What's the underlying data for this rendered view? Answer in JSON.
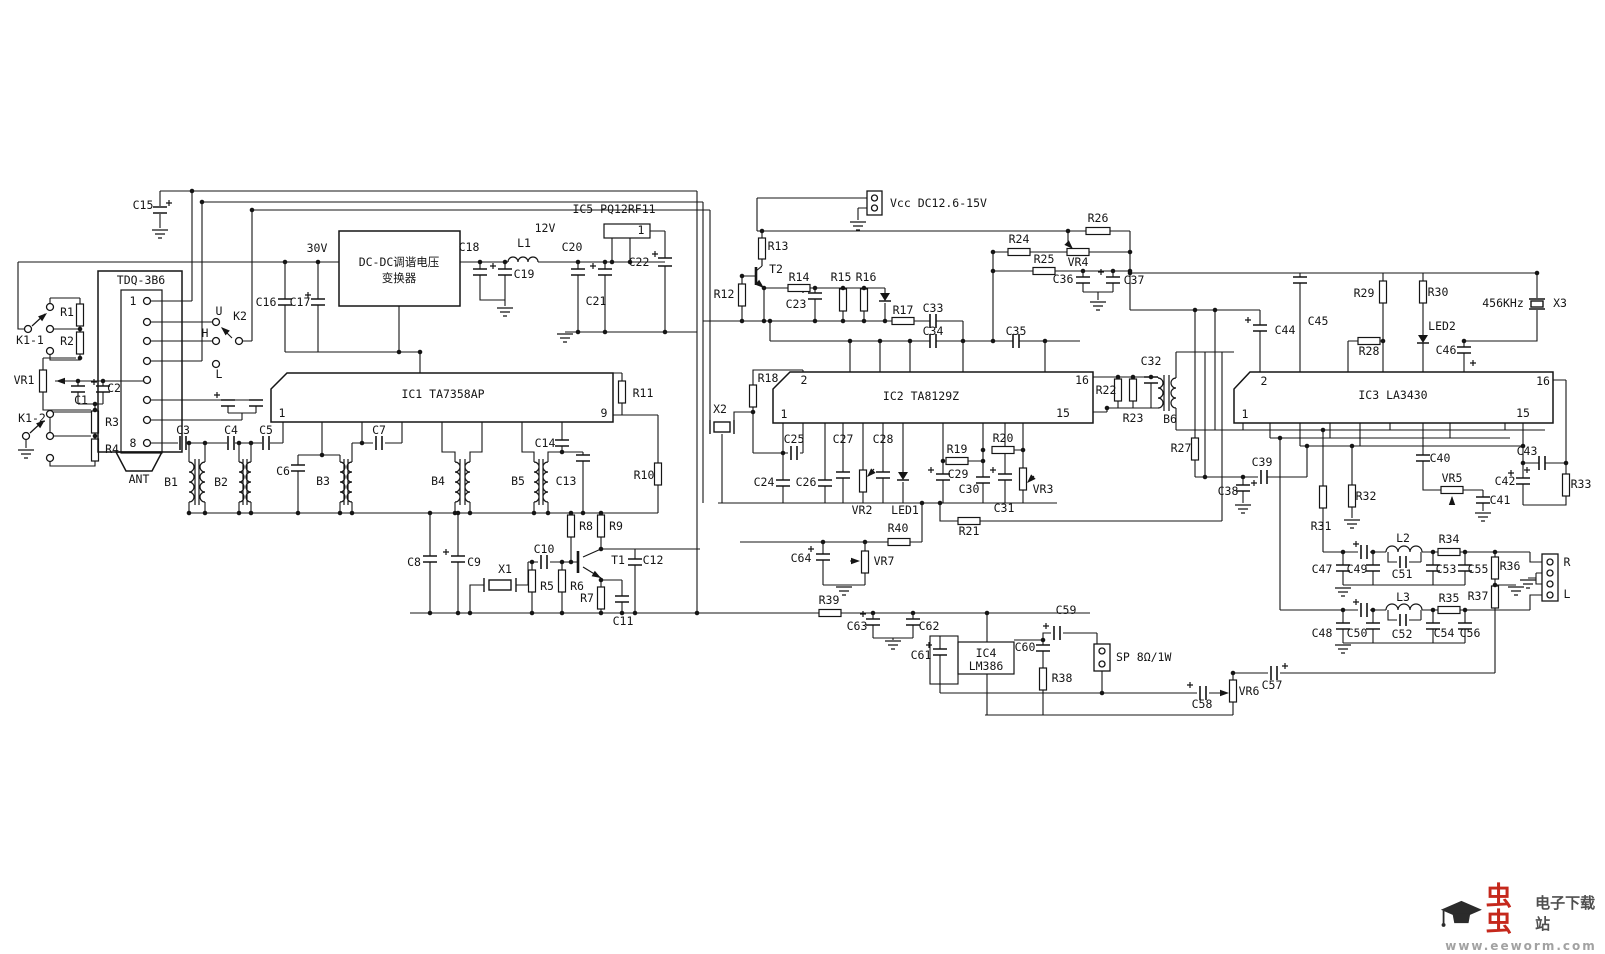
{
  "title": "FM radio receiver schematic (TA7358AP / TA8129Z / LA3430 / LM386)",
  "colors": {
    "ink": "#151515",
    "background": "#ffffff",
    "watermark_red": "#c5281c",
    "watermark_gray": "#4f4f4f",
    "watermark_url_gray": "#a2a2a2"
  },
  "watermark": {
    "brand": "虫虫",
    "site": "电子下载站",
    "url": "www.eeworm.com",
    "icon": "graduation-cap-icon"
  },
  "labels": [
    {
      "id": "c15",
      "t": "C15",
      "x": 143,
      "y": 209
    },
    {
      "id": "k1-1",
      "t": "K1-1",
      "x": 30,
      "y": 344
    },
    {
      "id": "r1",
      "t": "R1",
      "x": 67,
      "y": 316
    },
    {
      "id": "r2",
      "t": "R2",
      "x": 67,
      "y": 345
    },
    {
      "id": "vr1",
      "t": "VR1",
      "x": 24,
      "y": 384
    },
    {
      "id": "c1",
      "t": "C1",
      "x": 81,
      "y": 404,
      "fs": 11
    },
    {
      "id": "c2",
      "t": "C2",
      "x": 114,
      "y": 392
    },
    {
      "id": "k1-2",
      "t": "K1-2",
      "x": 32,
      "y": 422
    },
    {
      "id": "r3",
      "t": "R3",
      "x": 112,
      "y": 426
    },
    {
      "id": "r4",
      "t": "R4",
      "x": 112,
      "y": 453
    },
    {
      "id": "tdq",
      "t": "TDQ-3B6",
      "x": 141,
      "y": 284,
      "fs": 12
    },
    {
      "id": "tdq-pin1",
      "t": "1",
      "x": 133,
      "y": 305
    },
    {
      "id": "tdq-pin8",
      "t": "8",
      "x": 133,
      "y": 447
    },
    {
      "id": "ant",
      "t": "ANT",
      "x": 139,
      "y": 483
    },
    {
      "id": "k2-u",
      "t": "U",
      "x": 219,
      "y": 315
    },
    {
      "id": "k2",
      "t": "K2",
      "x": 240,
      "y": 320
    },
    {
      "id": "k2-h",
      "t": "H",
      "x": 205,
      "y": 337
    },
    {
      "id": "k2-l",
      "t": "L",
      "x": 219,
      "y": 378
    },
    {
      "id": "c16",
      "t": "C16",
      "x": 266,
      "y": 306
    },
    {
      "id": "c17",
      "t": "C17",
      "x": 300,
      "y": 306
    },
    {
      "id": "v30",
      "t": "30V",
      "x": 317,
      "y": 252
    },
    {
      "id": "dcdc1",
      "t": "DC-DC调谐电压",
      "x": 399,
      "y": 266,
      "fs": 13
    },
    {
      "id": "dcdc2",
      "t": "变换器",
      "x": 399,
      "y": 282,
      "fs": 13
    },
    {
      "id": "c18",
      "t": "C18",
      "x": 469,
      "y": 251
    },
    {
      "id": "l1",
      "t": "L1",
      "x": 524,
      "y": 247
    },
    {
      "id": "v12",
      "t": "12V",
      "x": 545,
      "y": 232
    },
    {
      "id": "c19",
      "t": "C19",
      "x": 524,
      "y": 278
    },
    {
      "id": "c20",
      "t": "C20",
      "x": 572,
      "y": 251
    },
    {
      "id": "c21",
      "t": "C21",
      "x": 596,
      "y": 305
    },
    {
      "id": "c22",
      "t": "C22",
      "x": 639,
      "y": 266
    },
    {
      "id": "ic5",
      "t": "IC5 PQ12RF11",
      "x": 614,
      "y": 213,
      "fs": 12
    },
    {
      "id": "ic5-pin1",
      "t": "1",
      "x": 641,
      "y": 234
    },
    {
      "id": "vcc",
      "t": "Vcc DC12.6-15V",
      "x": 890,
      "y": 207,
      "a": "start",
      "fs": 12
    },
    {
      "id": "r13",
      "t": "R13",
      "x": 778,
      "y": 250
    },
    {
      "id": "t2",
      "t": "T2",
      "x": 776,
      "y": 273
    },
    {
      "id": "r12",
      "t": "R12",
      "x": 724,
      "y": 298
    },
    {
      "id": "r14",
      "t": "R14",
      "x": 799,
      "y": 281
    },
    {
      "id": "c23",
      "t": "C23",
      "x": 796,
      "y": 308
    },
    {
      "id": "r15",
      "t": "R15",
      "x": 841,
      "y": 281
    },
    {
      "id": "r16",
      "t": "R16",
      "x": 866,
      "y": 281
    },
    {
      "id": "r17",
      "t": "R17",
      "x": 903,
      "y": 314
    },
    {
      "id": "c33",
      "t": "C33",
      "x": 933,
      "y": 312
    },
    {
      "id": "c34",
      "t": "C34",
      "x": 933,
      "y": 335
    },
    {
      "id": "c35",
      "t": "C35",
      "x": 1016,
      "y": 335
    },
    {
      "id": "r24",
      "t": "R24",
      "x": 1019,
      "y": 243
    },
    {
      "id": "r26",
      "t": "R26",
      "x": 1098,
      "y": 222
    },
    {
      "id": "r25",
      "t": "R25",
      "x": 1044,
      "y": 263
    },
    {
      "id": "vr4",
      "t": "VR4",
      "x": 1078,
      "y": 266
    },
    {
      "id": "c36",
      "t": "C36",
      "x": 1063,
      "y": 283
    },
    {
      "id": "c37",
      "t": "C37",
      "x": 1134,
      "y": 284
    },
    {
      "id": "ic1",
      "t": "IC1  TA7358AP",
      "x": 443,
      "y": 398,
      "fs": 13
    },
    {
      "id": "ic1-pin1",
      "t": "1",
      "x": 282,
      "y": 417
    },
    {
      "id": "ic1-pin9",
      "t": "9",
      "x": 604,
      "y": 417
    },
    {
      "id": "r11",
      "t": "R11",
      "x": 643,
      "y": 397
    },
    {
      "id": "r10",
      "t": "R10",
      "x": 644,
      "y": 479
    },
    {
      "id": "c3",
      "t": "C3",
      "x": 183,
      "y": 434
    },
    {
      "id": "c4",
      "t": "C4",
      "x": 231,
      "y": 434
    },
    {
      "id": "c5",
      "t": "C5",
      "x": 266,
      "y": 434
    },
    {
      "id": "b1",
      "t": "B1",
      "x": 171,
      "y": 486
    },
    {
      "id": "b2",
      "t": "B2",
      "x": 221,
      "y": 486
    },
    {
      "id": "c6",
      "t": "C6",
      "x": 283,
      "y": 475
    },
    {
      "id": "b3",
      "t": "B3",
      "x": 323,
      "y": 485
    },
    {
      "id": "c7",
      "t": "C7",
      "x": 379,
      "y": 434
    },
    {
      "id": "b4",
      "t": "B4",
      "x": 438,
      "y": 485
    },
    {
      "id": "b5",
      "t": "B5",
      "x": 518,
      "y": 485
    },
    {
      "id": "c13",
      "t": "C13",
      "x": 566,
      "y": 485
    },
    {
      "id": "c14",
      "t": "C14",
      "x": 545,
      "y": 447
    },
    {
      "id": "c8",
      "t": "C8",
      "x": 414,
      "y": 566
    },
    {
      "id": "c9",
      "t": "C9",
      "x": 474,
      "y": 566
    },
    {
      "id": "x1",
      "t": "X1",
      "x": 505,
      "y": 573
    },
    {
      "id": "c10",
      "t": "C10",
      "x": 544,
      "y": 553
    },
    {
      "id": "r5",
      "t": "R5",
      "x": 547,
      "y": 590
    },
    {
      "id": "r6",
      "t": "R6",
      "x": 577,
      "y": 590
    },
    {
      "id": "r7",
      "t": "R7",
      "x": 587,
      "y": 602
    },
    {
      "id": "r8",
      "t": "R8",
      "x": 586,
      "y": 530
    },
    {
      "id": "r9",
      "t": "R9",
      "x": 616,
      "y": 530
    },
    {
      "id": "t1",
      "t": "T1",
      "x": 618,
      "y": 564
    },
    {
      "id": "c12",
      "t": "C12",
      "x": 653,
      "y": 564
    },
    {
      "id": "c11",
      "t": "C11",
      "x": 623,
      "y": 625
    },
    {
      "id": "x2",
      "t": "X2",
      "x": 720,
      "y": 413
    },
    {
      "id": "r18",
      "t": "R18",
      "x": 768,
      "y": 382
    },
    {
      "id": "ic2",
      "t": "IC2  TA8129Z",
      "x": 921,
      "y": 400,
      "fs": 13
    },
    {
      "id": "ic2-pin2",
      "t": "2",
      "x": 804,
      "y": 384
    },
    {
      "id": "ic2-pin1",
      "t": "1",
      "x": 784,
      "y": 418
    },
    {
      "id": "ic2-pin16",
      "t": "16",
      "x": 1082,
      "y": 384
    },
    {
      "id": "ic2-pin15",
      "t": "15",
      "x": 1063,
      "y": 417
    },
    {
      "id": "c25",
      "t": "C25",
      "x": 794,
      "y": 443
    },
    {
      "id": "c27",
      "t": "C27",
      "x": 843,
      "y": 443
    },
    {
      "id": "c28",
      "t": "C28",
      "x": 883,
      "y": 443
    },
    {
      "id": "c24",
      "t": "C24",
      "x": 764,
      "y": 486
    },
    {
      "id": "c26",
      "t": "C26",
      "x": 806,
      "y": 486
    },
    {
      "id": "vr2",
      "t": "VR2",
      "x": 862,
      "y": 514
    },
    {
      "id": "led1",
      "t": "LED1",
      "x": 905,
      "y": 514
    },
    {
      "id": "r19",
      "t": "R19",
      "x": 957,
      "y": 453
    },
    {
      "id": "r20",
      "t": "R20",
      "x": 1003,
      "y": 442
    },
    {
      "id": "c29",
      "t": "C29",
      "x": 958,
      "y": 478
    },
    {
      "id": "c30",
      "t": "C30",
      "x": 969,
      "y": 493
    },
    {
      "id": "c31",
      "t": "C31",
      "x": 1004,
      "y": 512
    },
    {
      "id": "vr3",
      "t": "VR3",
      "x": 1043,
      "y": 493
    },
    {
      "id": "r21",
      "t": "R21",
      "x": 969,
      "y": 535
    },
    {
      "id": "r40",
      "t": "R40",
      "x": 898,
      "y": 532
    },
    {
      "id": "vr7",
      "t": "VR7",
      "x": 884,
      "y": 565
    },
    {
      "id": "c64",
      "t": "C64",
      "x": 801,
      "y": 562
    },
    {
      "id": "r39",
      "t": "R39",
      "x": 829,
      "y": 604
    },
    {
      "id": "c63",
      "t": "C63",
      "x": 857,
      "y": 630
    },
    {
      "id": "c62",
      "t": "C62",
      "x": 929,
      "y": 630
    },
    {
      "id": "c61",
      "t": "C61",
      "x": 921,
      "y": 659
    },
    {
      "id": "ic4a",
      "t": "IC4",
      "x": 986,
      "y": 657,
      "fs": 12
    },
    {
      "id": "ic4b",
      "t": "LM386",
      "x": 986,
      "y": 670,
      "fs": 12
    },
    {
      "id": "c60",
      "t": "C60",
      "x": 1025,
      "y": 651
    },
    {
      "id": "c59",
      "t": "C59",
      "x": 1066,
      "y": 614
    },
    {
      "id": "r38",
      "t": "R38",
      "x": 1062,
      "y": 682
    },
    {
      "id": "sp",
      "t": "SP 8Ω/1W",
      "x": 1116,
      "y": 661,
      "a": "start",
      "fs": 12
    },
    {
      "id": "c58",
      "t": "C58",
      "x": 1202,
      "y": 708
    },
    {
      "id": "vr6",
      "t": "VR6",
      "x": 1249,
      "y": 695
    },
    {
      "id": "c57",
      "t": "C57",
      "x": 1272,
      "y": 689
    },
    {
      "id": "r22",
      "t": "R22",
      "x": 1106,
      "y": 394
    },
    {
      "id": "r23",
      "t": "R23",
      "x": 1133,
      "y": 422
    },
    {
      "id": "c32",
      "t": "C32",
      "x": 1151,
      "y": 365
    },
    {
      "id": "b6",
      "t": "B6",
      "x": 1170,
      "y": 423
    },
    {
      "id": "r27",
      "t": "R27",
      "x": 1181,
      "y": 452
    },
    {
      "id": "c39",
      "t": "C39",
      "x": 1262,
      "y": 466
    },
    {
      "id": "c38",
      "t": "C38",
      "x": 1228,
      "y": 495
    },
    {
      "id": "ic3",
      "t": "IC3  LA3430",
      "x": 1393,
      "y": 399,
      "fs": 13
    },
    {
      "id": "ic3-pin2",
      "t": "2",
      "x": 1264,
      "y": 385
    },
    {
      "id": "ic3-pin1",
      "t": "1",
      "x": 1245,
      "y": 418
    },
    {
      "id": "ic3-pin16",
      "t": "16",
      "x": 1543,
      "y": 385
    },
    {
      "id": "ic3-pin15",
      "t": "15",
      "x": 1523,
      "y": 417
    },
    {
      "id": "c44",
      "t": "C44",
      "x": 1285,
      "y": 334
    },
    {
      "id": "c45",
      "t": "C45",
      "x": 1318,
      "y": 325
    },
    {
      "id": "r29",
      "t": "R29",
      "x": 1364,
      "y": 297
    },
    {
      "id": "r30",
      "t": "R30",
      "x": 1438,
      "y": 296
    },
    {
      "id": "r28",
      "t": "R28",
      "x": 1369,
      "y": 355
    },
    {
      "id": "led2",
      "t": "LED2",
      "x": 1442,
      "y": 330
    },
    {
      "id": "c46",
      "t": "C46",
      "x": 1446,
      "y": 354
    },
    {
      "id": "x3-freq",
      "t": "456KHz",
      "x": 1503,
      "y": 307
    },
    {
      "id": "x3",
      "t": "X3",
      "x": 1560,
      "y": 307
    },
    {
      "id": "c40",
      "t": "C40",
      "x": 1440,
      "y": 462
    },
    {
      "id": "vr5",
      "t": "VR5",
      "x": 1452,
      "y": 482
    },
    {
      "id": "c41",
      "t": "C41",
      "x": 1500,
      "y": 504
    },
    {
      "id": "c42",
      "t": "C42",
      "x": 1505,
      "y": 485
    },
    {
      "id": "c43",
      "t": "C43",
      "x": 1527,
      "y": 455
    },
    {
      "id": "r33",
      "t": "R33",
      "x": 1581,
      "y": 488
    },
    {
      "id": "r31",
      "t": "R31",
      "x": 1321,
      "y": 530
    },
    {
      "id": "r32",
      "t": "R32",
      "x": 1366,
      "y": 500
    },
    {
      "id": "l2",
      "t": "L2",
      "x": 1403,
      "y": 542
    },
    {
      "id": "r34",
      "t": "R34",
      "x": 1449,
      "y": 543
    },
    {
      "id": "c47",
      "t": "C47",
      "x": 1322,
      "y": 573
    },
    {
      "id": "c49",
      "t": "C49",
      "x": 1357,
      "y": 573
    },
    {
      "id": "c51",
      "t": "C51",
      "x": 1402,
      "y": 578
    },
    {
      "id": "c53",
      "t": "C53",
      "x": 1446,
      "y": 573
    },
    {
      "id": "c55",
      "t": "C55",
      "x": 1478,
      "y": 573
    },
    {
      "id": "r36",
      "t": "R36",
      "x": 1510,
      "y": 570
    },
    {
      "id": "out-r",
      "t": "R",
      "x": 1567,
      "y": 566
    },
    {
      "id": "out-l",
      "t": "L",
      "x": 1567,
      "y": 598
    },
    {
      "id": "r37",
      "t": "R37",
      "x": 1478,
      "y": 600
    },
    {
      "id": "l3",
      "t": "L3",
      "x": 1403,
      "y": 601
    },
    {
      "id": "r35",
      "t": "R35",
      "x": 1449,
      "y": 602
    },
    {
      "id": "c48",
      "t": "C48",
      "x": 1322,
      "y": 637
    },
    {
      "id": "c50",
      "t": "C50",
      "x": 1357,
      "y": 637
    },
    {
      "id": "c52",
      "t": "C52",
      "x": 1402,
      "y": 638
    },
    {
      "id": "c54",
      "t": "C54",
      "x": 1444,
      "y": 637
    },
    {
      "id": "c56",
      "t": "C56",
      "x": 1470,
      "y": 637
    }
  ]
}
